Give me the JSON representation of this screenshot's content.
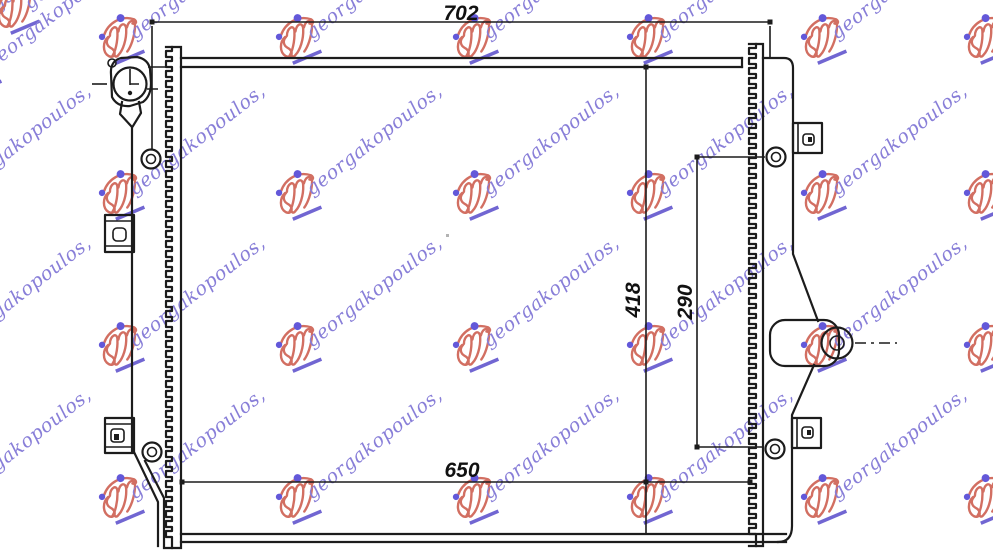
{
  "canvas": {
    "width": 993,
    "height": 553,
    "background": "#ffffff"
  },
  "drawing": {
    "type": "technical-part-drawing",
    "subject": "radiator front view with mounting brackets, filler cap and outlet pipe",
    "line_color": "#1c1c1c",
    "label_color": "#111111",
    "dimensions": [
      {
        "id": "overall-width-top",
        "value": "702",
        "orientation": "horizontal",
        "position": "top"
      },
      {
        "id": "core-width-bottom",
        "value": "650",
        "orientation": "horizontal",
        "position": "bottom"
      },
      {
        "id": "overall-height",
        "value": "418",
        "orientation": "vertical",
        "position": "right"
      },
      {
        "id": "mount-span-height",
        "value": "290",
        "orientation": "vertical",
        "position": "right-inner"
      }
    ],
    "features": [
      "filler-cap",
      "core-fins",
      "mounting-bracket-x4",
      "mounting-bolt-x4",
      "outlet-pipe",
      "center-line"
    ]
  },
  "watermark": {
    "text": "georgakopoulos,",
    "logo": "georgakopoulos-script-logo",
    "text_color": "#8278d6",
    "logo_color": "#d0685a",
    "dot_color": "#5b50d8",
    "underline_color": "#6a5ed0",
    "rotation_deg": -38,
    "columns_x": [
      -51,
      123,
      300,
      477,
      651,
      825,
      988
    ],
    "rows_y": [
      40,
      196,
      348,
      500
    ],
    "extra_units": [
      {
        "x": 18,
        "y": 10
      },
      {
        "x": -20,
        "y": 70
      }
    ]
  }
}
